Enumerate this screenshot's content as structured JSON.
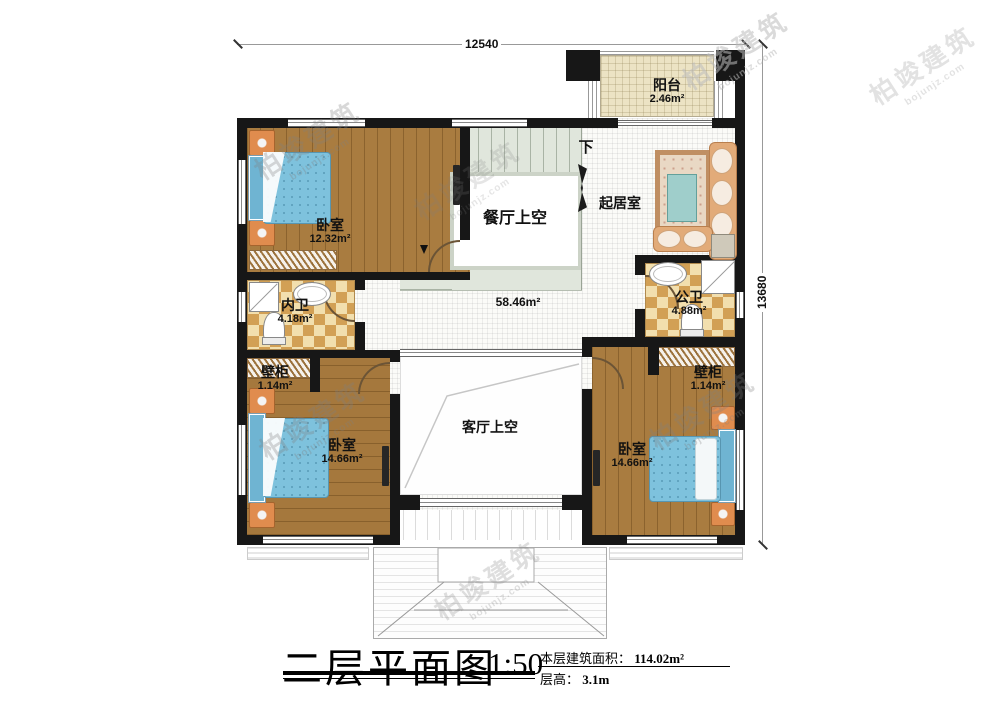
{
  "dimensions": {
    "width_label": "12540",
    "height_label": "13680"
  },
  "rooms": {
    "balcony": {
      "name": "阳台",
      "area": "2.46m²"
    },
    "bedroom1": {
      "name": "卧室",
      "area": "12.32m²"
    },
    "bedroom2": {
      "name": "卧室",
      "area": "14.66m²"
    },
    "bedroom3": {
      "name": "卧室",
      "area": "14.66m²"
    },
    "inner_bath": {
      "name": "内卫",
      "area": "4.18m²"
    },
    "public_bath": {
      "name": "公卫",
      "area": "4.88m²"
    },
    "closet_left": {
      "name": "壁柜",
      "area": "1.14m²"
    },
    "closet_right": {
      "name": "壁柜",
      "area": "1.14m²"
    },
    "living": {
      "name": "起居室"
    },
    "dining_void": {
      "name": "餐厅上空"
    },
    "living_void": {
      "name": "客厅上空"
    },
    "hall": {
      "area": "58.46m²"
    },
    "stairs": {
      "direction": "下"
    }
  },
  "title_block": {
    "title": "二层平面图",
    "scale": "1:50",
    "area_label": "本层建筑面积：",
    "area_value": "114.02m²",
    "height_label": "层高：",
    "height_value": "3.1m"
  },
  "watermark": {
    "brand": "柏竣建筑",
    "site": "bojunjz.com"
  }
}
